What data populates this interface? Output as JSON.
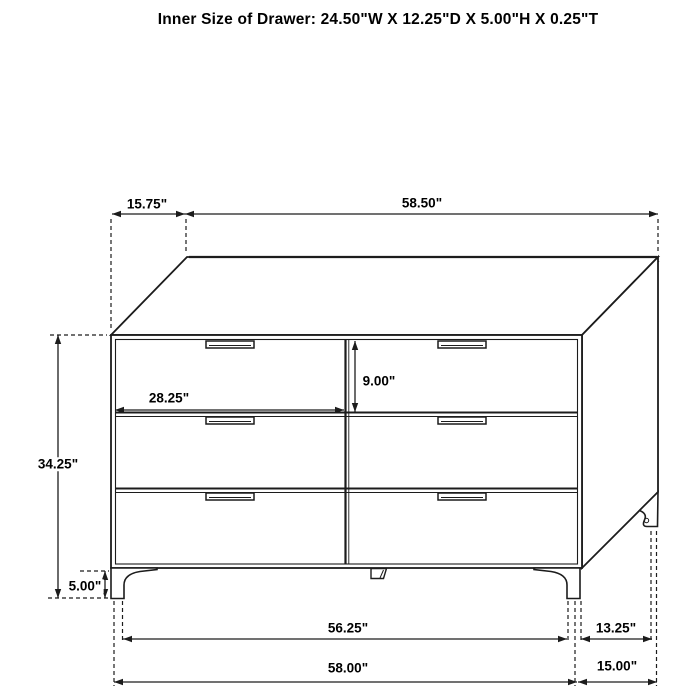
{
  "title": "Inner Size of Drawer: 24.50\"W X 12.25\"D X 5.00\"H X 0.25\"T",
  "diagram": {
    "type": "furniture-dimension-diagram",
    "item": "six-drawer dresser, isometric line drawing",
    "colors": {
      "line": "#1c1c1c",
      "background": "#ffffff",
      "text": "#000000"
    },
    "labels": {
      "top_depth": "15.75\"",
      "top_width": "58.50\"",
      "overall_height": "34.25\"",
      "leg_height": "5.00\"",
      "drawer_front_width": "28.25\"",
      "drawer_front_height": "9.00\"",
      "base_inner_width": "56.25\"",
      "base_overall_width": "58.00\"",
      "base_inner_depth": "13.25\"",
      "base_overall_depth": "15.00\""
    }
  }
}
